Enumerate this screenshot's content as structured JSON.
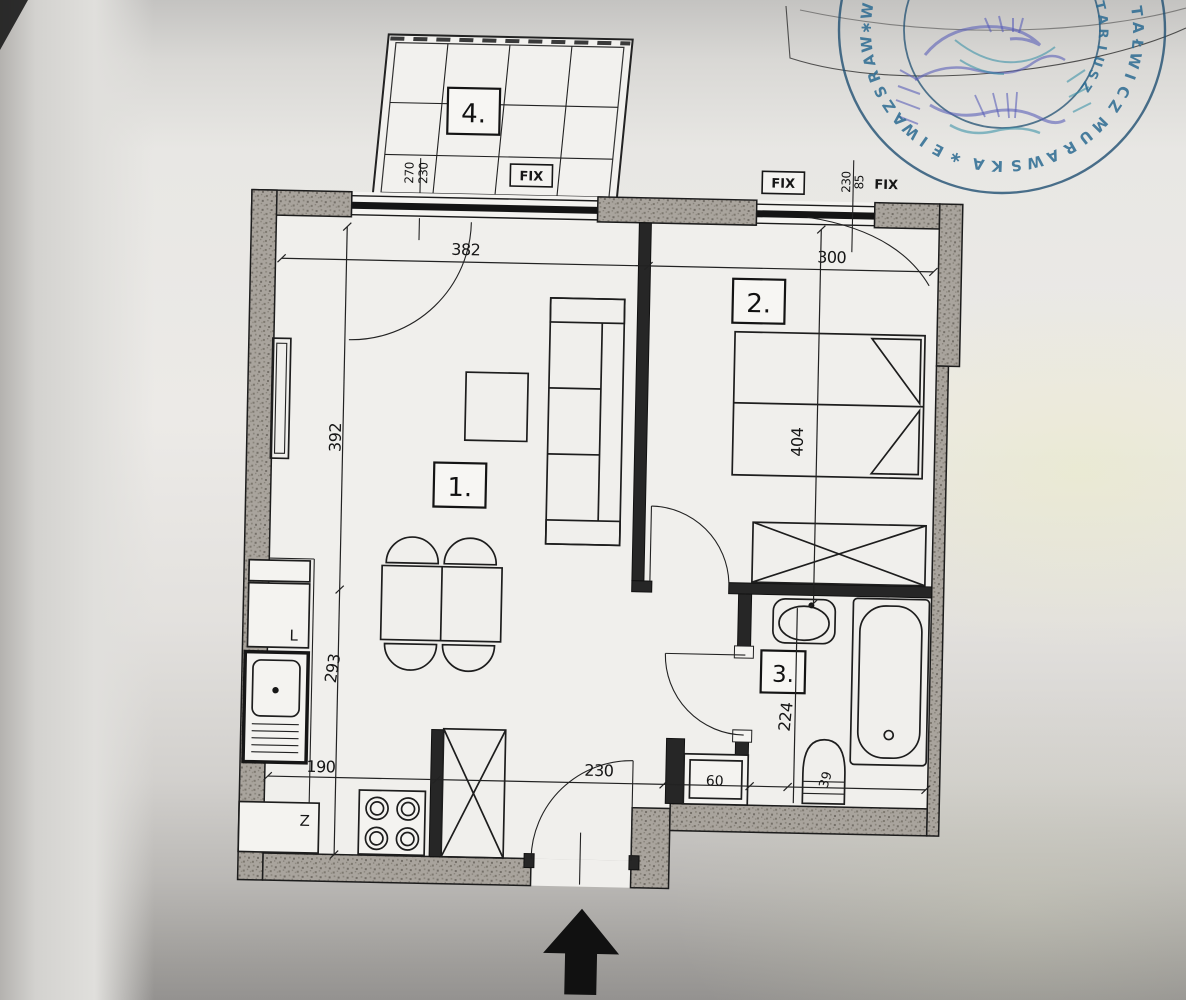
{
  "document": {
    "type": "apartment floor plan scan"
  },
  "rooms": [
    {
      "label": "1.",
      "name": "living-room"
    },
    {
      "label": "2.",
      "name": "bedroom"
    },
    {
      "label": "3.",
      "name": "bathroom"
    },
    {
      "label": "4.",
      "name": "balcony"
    }
  ],
  "dims": {
    "living_w": "382",
    "bedroom_w": "300",
    "living_h": "392",
    "kitchen_h": "293",
    "bedroom_h": "404",
    "bath_h": "224",
    "kitchen_w": "190",
    "hall_w": "230",
    "washer_w": "60",
    "toilet_w": "39"
  },
  "window_specs": {
    "balcony_a": "270",
    "balcony_b": "230",
    "bedroom_a": "230",
    "bedroom_b": "85",
    "fix_balcony": "FIX",
    "fix_bedroom_boxed": "FIX",
    "fix_bedroom_plain": "FIX"
  },
  "kitchen_labels": {
    "fridge": "L",
    "appliance": "Z"
  },
  "stamp": {
    "outer_letters": [
      {
        "a": 188,
        "c": "W"
      },
      {
        "a": 181,
        "c": "∗"
      },
      {
        "a": 174,
        "c": "W"
      },
      {
        "a": 167,
        "c": "A"
      },
      {
        "a": 160,
        "c": "R"
      },
      {
        "a": 153,
        "c": "S"
      },
      {
        "a": 146,
        "c": "Z"
      },
      {
        "a": 139,
        "c": "A"
      },
      {
        "a": 132,
        "c": "W"
      },
      {
        "a": 125,
        "c": "I"
      },
      {
        "a": 118,
        "c": "E"
      },
      {
        "a": 110,
        "c": "∗"
      },
      {
        "a": 100,
        "c": "A"
      },
      {
        "a": 92,
        "c": "K"
      },
      {
        "a": 84,
        "c": "S"
      },
      {
        "a": 76,
        "c": "W"
      },
      {
        "a": 68,
        "c": "A"
      },
      {
        "a": 60,
        "c": "R"
      },
      {
        "a": 52,
        "c": "U"
      },
      {
        "a": 44,
        "c": "M"
      },
      {
        "a": 34,
        "c": "Z"
      },
      {
        "a": 27,
        "c": "C"
      },
      {
        "a": 20,
        "c": "I"
      },
      {
        "a": 13,
        "c": "W"
      },
      {
        "a": 6,
        "c": "Ł"
      },
      {
        "a": -1,
        "c": "A"
      },
      {
        "a": -8,
        "c": "T"
      }
    ],
    "inner_letters": [
      {
        "a": 34,
        "c": "Z"
      },
      {
        "a": 26,
        "c": "S"
      },
      {
        "a": 18,
        "c": "U"
      },
      {
        "a": 10,
        "c": "I"
      },
      {
        "a": 2,
        "c": "R"
      },
      {
        "a": -6,
        "c": "A"
      },
      {
        "a": -14,
        "c": "T"
      },
      {
        "a": -22,
        "c": "O"
      },
      {
        "a": -30,
        "c": "N"
      }
    ]
  }
}
